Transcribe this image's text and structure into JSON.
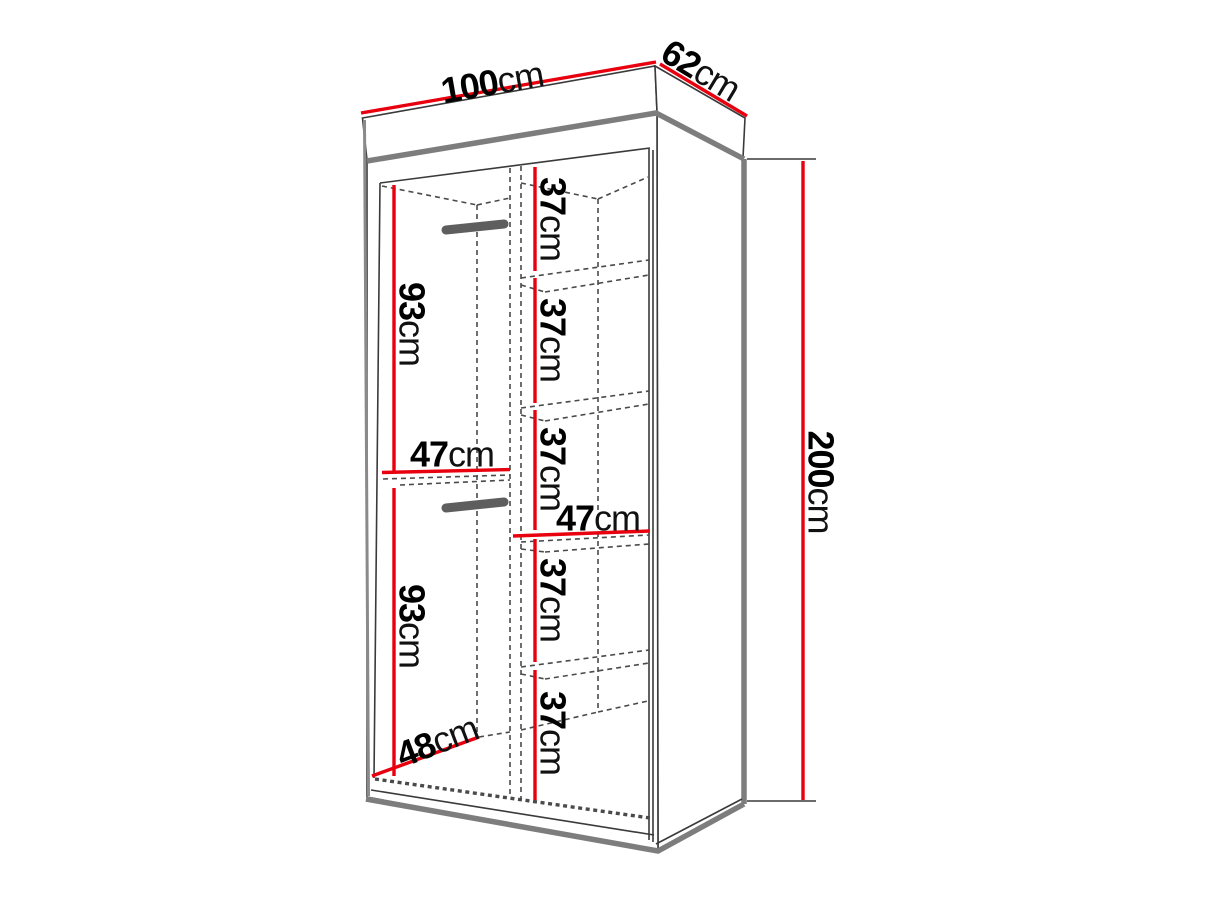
{
  "figure_title": "wardrobe dimension diagram",
  "colors": {
    "dimension_line": "#e8000f",
    "outline": "#3a3a3a",
    "shadow_gray": "#7d7d7d",
    "background": "#ffffff",
    "label_text": "#000000"
  },
  "labels": {
    "width": {
      "num": "100",
      "unit": "cm"
    },
    "depth": {
      "num": "62",
      "unit": "cm"
    },
    "height": {
      "num": "200",
      "unit": "cm"
    },
    "shelves": [
      {
        "num": "37",
        "unit": "cm"
      },
      {
        "num": "37",
        "unit": "cm"
      },
      {
        "num": "37",
        "unit": "cm"
      },
      {
        "num": "37",
        "unit": "cm"
      },
      {
        "num": "37",
        "unit": "cm"
      }
    ],
    "hang": [
      {
        "num": "93",
        "unit": "cm"
      },
      {
        "num": "93",
        "unit": "cm"
      }
    ],
    "inner_width_left": {
      "num": "47",
      "unit": "cm"
    },
    "inner_width_right": {
      "num": "47",
      "unit": "cm"
    },
    "inner_depth": {
      "num": "48",
      "unit": "cm"
    }
  },
  "dimensions_cm": {
    "overall": {
      "width": 100,
      "depth": 62,
      "height": 200
    },
    "shelf_sections": [
      37,
      37,
      37,
      37,
      37
    ],
    "hanging_sections": [
      93,
      93
    ],
    "left_column_width": 47,
    "right_column_width": 47,
    "interior_depth": 48
  }
}
